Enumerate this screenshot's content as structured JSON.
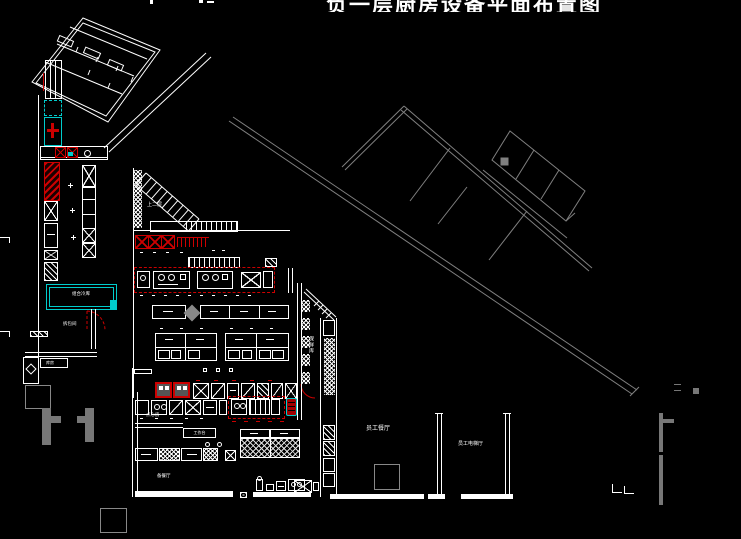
{
  "title": "负一层厨房设备平面布置图",
  "colors": {
    "background": "#000000",
    "line": "#ffffff",
    "accent_red": "#cc0000",
    "accent_cyan": "#00cccc",
    "muted_gray": "#808080"
  },
  "labels": {
    "stairs": "上二层",
    "cold_room": "组合冷库",
    "unpack_room": "拆包间",
    "pastry_room": "点心房",
    "serving_room": "备餐厅",
    "staff_dining": "员工餐厅",
    "elevator_hall": "员工电梯厅",
    "fresh_store": "保鲜库",
    "work_table": "工作台",
    "storage": "库房"
  }
}
